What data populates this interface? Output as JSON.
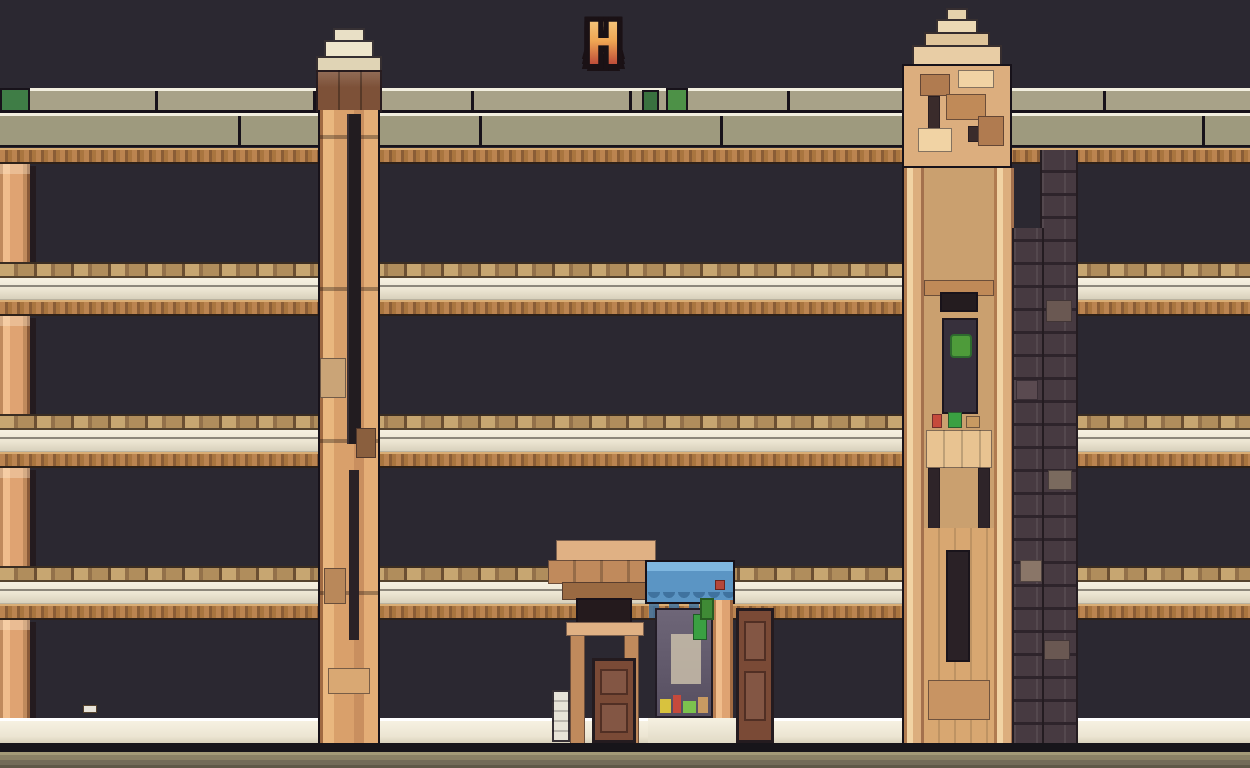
{
  "scene": {
    "description": "Pixel-art city building facade at night: four floors of windows with plants, two ornamental towers, blue shop awning over the entrance, dark sky and street",
    "sign": {
      "text": "IINAHAH"
    },
    "floors_count": 4,
    "windows_per_floor": 11
  },
  "building": {
    "module_pitch": 113.64,
    "pilaster_width": 30,
    "floors": [
      {
        "id": "floor-4",
        "windows_top": 164,
        "windows_h": 98,
        "ground": false
      },
      {
        "id": "floor-3",
        "windows_top": 316,
        "windows_h": 98,
        "ground": false
      },
      {
        "id": "floor-2",
        "windows_top": 468,
        "windows_h": 98,
        "ground": false
      },
      {
        "id": "floor-1",
        "windows_top": 620,
        "windows_h": 98,
        "ground": true
      }
    ],
    "lit_ground_window_column": 7
  },
  "palette": {
    "bg": "#2b2831",
    "line": "#17121a",
    "parapet1": "#a8a288",
    "parapet2": "#9e9a7e",
    "parapetHi": "#f2efdf",
    "copper1": "#bb8450",
    "copper2": "#8a5d36",
    "copper3": "#a9753f",
    "copperHi": "#d9ad74",
    "pil1": "#f0bd8c",
    "pil2": "#dfa372",
    "pil3": "#c08a5c",
    "frameDark": "#241b1f",
    "valance": "#4b3842",
    "glass1": "#6a6375",
    "glass2": "#514b5e",
    "glassHi": "#948da0",
    "glassLit1": "#e8a74e",
    "glassLit2": "#b5742f",
    "sill1": "#c7a671",
    "sill2": "#93714a",
    "sill3": "#b08d5c",
    "cream": "#ece5d2",
    "creamHi": "#f6f1e2",
    "creamSh": "#d8d1bc",
    "streetDark": "#17151a",
    "road1": "#a39a77",
    "road2": "#8a8165",
    "road3": "#736b58",
    "awn1": "#7fb7e0",
    "awn2": "#5b95c4",
    "awn3": "#3f729f",
    "door": "#7a4a36",
    "doorDark": "#512f24",
    "wood1": "#c08a5c",
    "wood2": "#9a6a42",
    "wood3": "#e0b184",
    "tL": "#d9a06b",
    "tL-hi": "#e9b77f",
    "tR": "#dcae7e",
    "tR-hi": "#f1d3a4",
    "tR-sh": "#b07b50",
    "brickBg": "#473a41",
    "signOut": "#1a1115",
    "greenSign": "#4d9147"
  },
  "item_colors": [
    "#4e9b3a",
    "#7cc24e",
    "#2e6b2e",
    "#e070a8",
    "#c64a3c",
    "#e8e4da",
    "#c89a62",
    "#d8c23e",
    "#4a7fae",
    "#b5473a"
  ],
  "green_shades": [
    "#4e9b3a",
    "#7cc24e",
    "#2e6b2e"
  ]
}
